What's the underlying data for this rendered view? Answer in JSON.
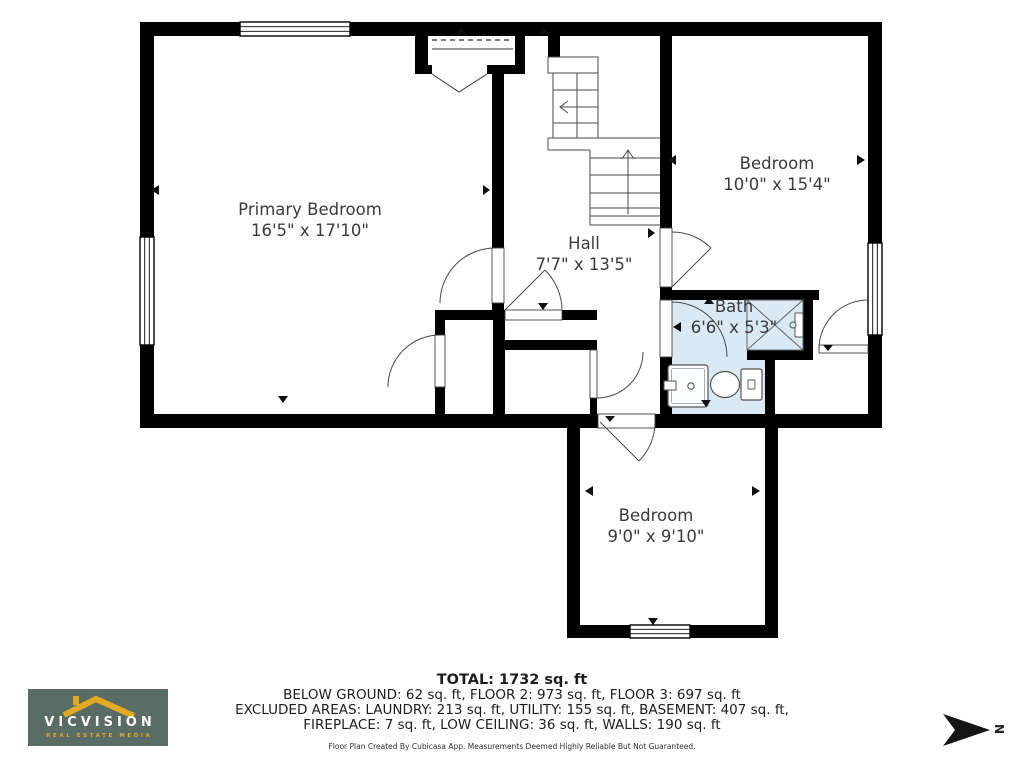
{
  "plan": {
    "rooms": [
      {
        "name": "Primary Bedroom",
        "dims": "16'5\" x 17'10\""
      },
      {
        "name": "Hall",
        "dims": "7'7\" x 13'5\""
      },
      {
        "name": "Bedroom",
        "dims": "10'0\" x 15'4\""
      },
      {
        "name": "Bath",
        "dims": "6'6\" x 5'3\""
      },
      {
        "name": "Bedroom",
        "dims": "9'0\" x 9'10\""
      }
    ]
  },
  "summary": {
    "total": "TOTAL: 1732 sq. ft",
    "floors": "BELOW GROUND: 62 sq. ft, FLOOR 2: 973 sq. ft, FLOOR 3: 697 sq. ft",
    "excluded1": "EXCLUDED AREAS: LAUNDRY: 213 sq. ft, UTILITY: 155 sq. ft, BASEMENT: 407 sq. ft,",
    "excluded2": "FIREPLACE: 7 sq. ft, LOW CEILING: 36 sq. ft, WALLS: 190 sq. ft",
    "disclaimer": "Floor Plan Created By Cubicasa App. Measurements Deemed Highly Reliable But Not Guaranteed."
  },
  "logo": {
    "brand": "VICVISION",
    "tagline": "REAL ESTATE MEDIA",
    "bg_color": "#5a6c66",
    "accent_color": "#e3aa1f",
    "text_color": "#ffffff"
  },
  "compass": {
    "label": "N"
  },
  "colors": {
    "wall": "#000000",
    "bath_fill": "#d9eaf6",
    "thin_line": "#4a4a4a",
    "label_text": "#3b3b3b"
  }
}
